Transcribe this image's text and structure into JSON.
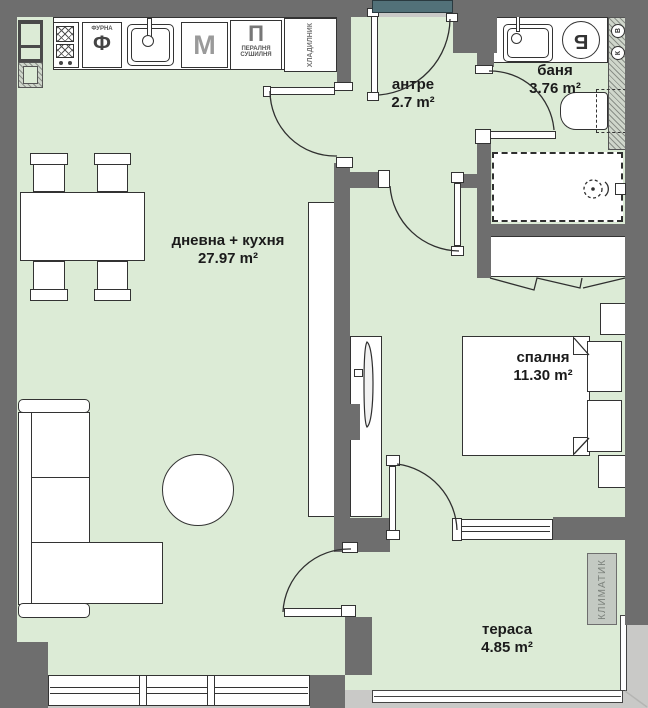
{
  "theme": {
    "floor": "#dcebd6",
    "wall": "#6e6e6e",
    "outline": "#2f2f2f",
    "door_mat": "#527179",
    "outside": "#c9c9c7",
    "label": "#1b1b1b"
  },
  "rooms": {
    "living": {
      "name": "дневна + кухня",
      "area": "27.97 m²"
    },
    "entry": {
      "name": "антре",
      "area": "2.7 m²"
    },
    "bath": {
      "name": "баня",
      "area": "3.76 m²"
    },
    "bedroom": {
      "name": "спалня",
      "area": "11.30 m²"
    },
    "terrace": {
      "name": "тераса",
      "area": "4.85 m²"
    }
  },
  "kitchen": {
    "oven_small": "ФУРНА",
    "oven_letter": "Ф",
    "dishwasher_letter": "М",
    "laundry_letter": "П",
    "laundry_sub1": "ПЕРАЛНЯ",
    "laundry_sub2": "СУШИЛНЯ",
    "fridge_label": "ХЛАДИЛНИК"
  },
  "bathroom": {
    "boiler_letter": "Б",
    "riser_top": "В",
    "riser_bottom": "К"
  },
  "terrace_items": {
    "hvac_label": "КЛИМАТИК"
  }
}
